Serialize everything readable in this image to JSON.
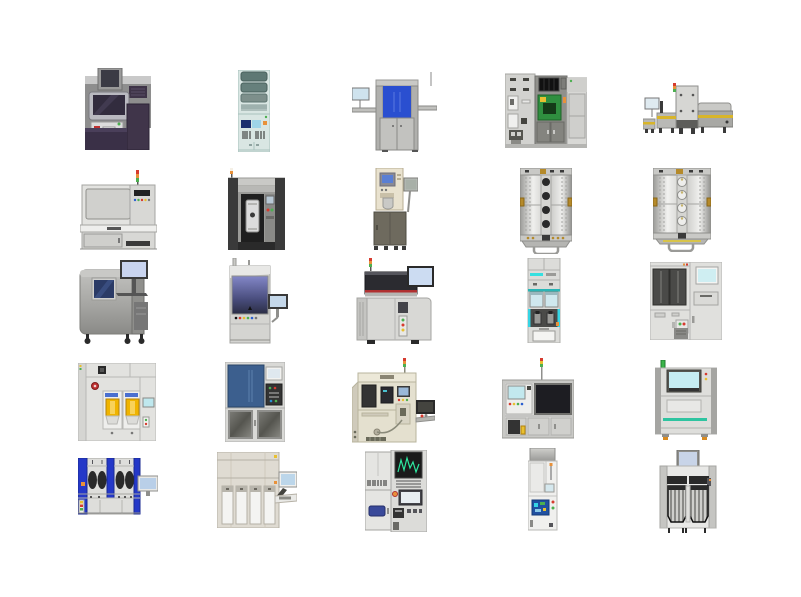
{
  "page": {
    "kind": "equipment-clipart-sheet",
    "background_color": "#ffffff",
    "grid": {
      "rows": 5,
      "cols": 5,
      "machine_count": 25
    }
  },
  "palette": {
    "signal_red": "#d63b2f",
    "signal_orange": "#e8913a",
    "signal_green": "#4caf50",
    "loadport_yellow": "#f0b400",
    "window_blue": "#2a4fd0",
    "panel_steel_blue": "#3c5f8e",
    "pcb_green": "#2f8f3f",
    "accent_cyan": "#35d5e5",
    "teal_stripe": "#2ec4a0",
    "screen_light_blue": "#c5ecf2",
    "dark_purple": "#3a3047",
    "mint_body": "#d9e6e3",
    "beige_body": "#e4e0cf",
    "metal_light": "#dededb",
    "metal_dark": "#3a3a3a"
  },
  "machines": [
    {
      "name": "metrology-station",
      "label": "Purple metrology station with top monitor",
      "row": 1,
      "col": 1
    },
    {
      "name": "reagent-tower",
      "label": "Mint tower rack with shelves and barcode panel",
      "row": 1,
      "col": 2
    },
    {
      "name": "blue-window-inspection",
      "label": "Inspection tool with blue window and side monitor",
      "row": 1,
      "col": 3
    },
    {
      "name": "cluster-cabinet",
      "label": "Gray cluster cabinet with green PCB panel",
      "row": 1,
      "col": 4
    },
    {
      "name": "conveyor-line",
      "label": "Conveyor line with center tower and signal lamp",
      "row": 1,
      "col": 5
    },
    {
      "name": "bench-tester",
      "label": "Bench tester with window, button panel and signal tower",
      "row": 2,
      "col": 1
    },
    {
      "name": "wafer-chamber-tool",
      "label": "Dark-pillar tool with wafer cassette chamber",
      "row": 2,
      "col": 2
    },
    {
      "name": "standalone-dispenser",
      "label": "Cream dispenser head on olive cabinet with arm monitor",
      "row": 2,
      "col": 3
    },
    {
      "name": "vacuum-chamber-dark-ports",
      "label": "Riveted vacuum chamber with dark ports",
      "row": 2,
      "col": 4
    },
    {
      "name": "vacuum-chamber-light-ports",
      "label": "Riveted vacuum chamber with light ports",
      "row": 2,
      "col": 5
    },
    {
      "name": "microscope-cabinet",
      "label": "Rounded SEM cabinet with monitor and keyboard tray",
      "row": 3,
      "col": 1
    },
    {
      "name": "gradient-window-column",
      "label": "Column tool with purple gradient window and side monitor",
      "row": 3,
      "col": 2
    },
    {
      "name": "prober-with-monitor",
      "label": "Prober with dark head, red stripe and monitor",
      "row": 3,
      "col": 3
    },
    {
      "name": "sorter-tower",
      "label": "Narrow sorter tower with cyan accents",
      "row": 3,
      "col": 4
    },
    {
      "name": "two-window-cabinet",
      "label": "Wide cabinet with two dark windows and screen",
      "row": 3,
      "col": 5
    },
    {
      "name": "track-loadports",
      "label": "Track system with two yellow load ports",
      "row": 4,
      "col": 1
    },
    {
      "name": "blue-panel-cabinet",
      "label": "Cabinet with steel-blue panel and mesh doors",
      "row": 4,
      "col": 2
    },
    {
      "name": "beige-bonder",
      "label": "Beige bonder with dark panels and side table monitor",
      "row": 4,
      "col": 3
    },
    {
      "name": "assembly-cell",
      "label": "Assembly cell with big dark window and signal tower",
      "row": 4,
      "col": 4
    },
    {
      "name": "aoi-machine",
      "label": "AOI machine with cyan screen, teal stripe and orange feet",
      "row": 4,
      "col": 5
    },
    {
      "name": "wet-bench",
      "label": "Wet bench with blue pillars and four dark ovals",
      "row": 5,
      "col": 1
    },
    {
      "name": "chemical-dispense-tower",
      "label": "Tall greige unit with four white cassettes and terminal",
      "row": 5,
      "col": 2
    },
    {
      "name": "test-rack-oscilloscope",
      "label": "Test rack with green-waveform CRT and wide screen",
      "row": 5,
      "col": 3
    },
    {
      "name": "compact-analyzer",
      "label": "Compact analyzer with blue control board",
      "row": 5,
      "col": 4
    },
    {
      "name": "dual-loadport-machine",
      "label": "Machine with top screen and two ribbed chambers",
      "row": 5,
      "col": 5
    }
  ]
}
